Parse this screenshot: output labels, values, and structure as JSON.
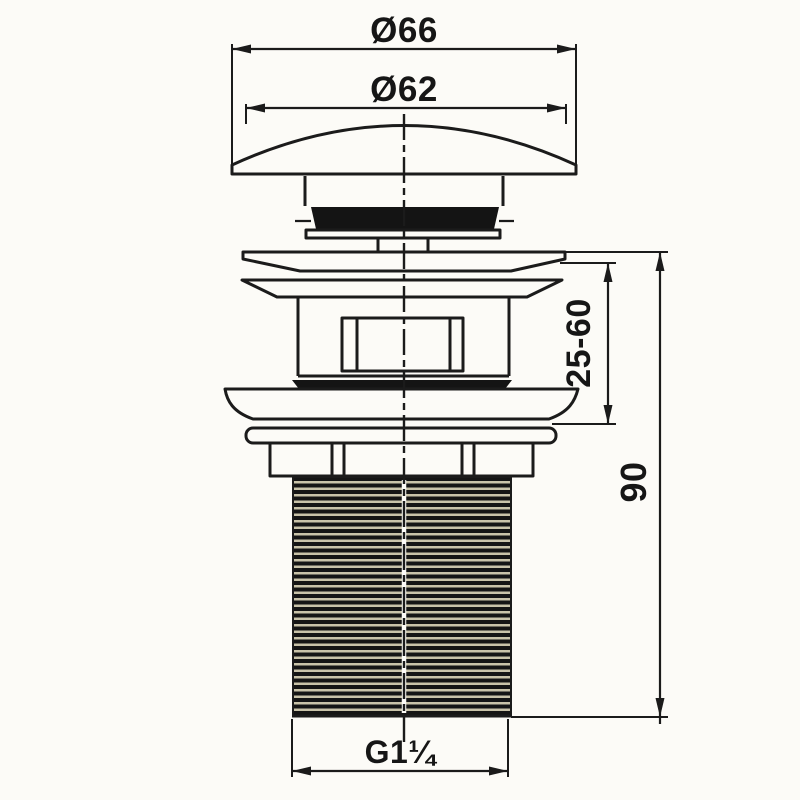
{
  "drawing": {
    "type": "technical-dimension-drawing",
    "subject": "pop-up basin waste / drain fitting side elevation",
    "labels": {
      "cap_outer_diameter": "Ø66",
      "cap_top_diameter": "Ø62",
      "clamp_range": "25-60",
      "thread_height": "90",
      "thread_size": "G1¼"
    },
    "colors": {
      "line": "#1b1b1b",
      "background": "#fcfbf7",
      "fill_dark": "#141414",
      "thread_gap": "#c9c3a9"
    }
  }
}
